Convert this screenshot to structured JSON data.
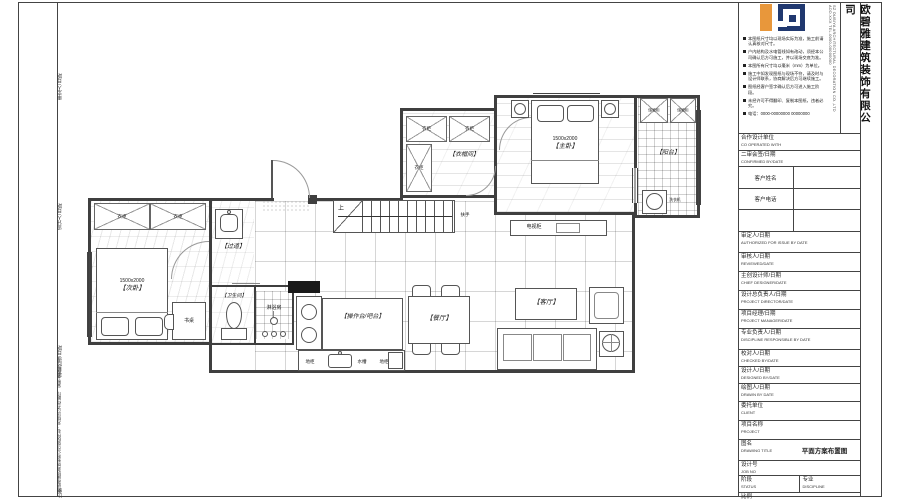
{
  "frame": {
    "edge_labels": {
      "l1": "审定人/日期",
      "l2": "设计人/日期",
      "l3": "项目经理/日期",
      "l4": "欧碧雅建筑装饰有限公司版权所有 · 未经许可不得翻印、复制本图纸",
      "l5": "比例"
    }
  },
  "header": {
    "company_vertical": "欧碧雅建筑装饰有限公司",
    "fine_print": "SZ OUBIYA ARCHITECTURAL DECORATION CO.,LTD ADD.XXX TEL.0000-00000000",
    "notes": [
      "本图纸尺寸均以现场实际为准，施工前请认真核对尺寸。",
      "户内结构及水电管线如有改动，须经本公司确认后方可施工，并以现场交底为准。",
      "本图所有尺寸均以毫米（mm）为单位。",
      "施工中如发现图纸与现场不符，请及时与设计师联系，协商解决后方可继续施工。",
      "图纸经客户签字确认后方可进入施工阶段。",
      "未经许可不得翻印、复制本图纸，违者必究。",
      "电话：0000-00000000 00000000"
    ],
    "colors": {
      "orange": "#E8973B",
      "blue": "#20386F"
    }
  },
  "titleblock": {
    "rows": [
      {
        "zh": "合作设计单位",
        "en": "CO OPERATED WITH"
      },
      {
        "zh": "二审会签/日期",
        "en": "CONFIRMED BY/DATE"
      },
      {
        "zh": "客户姓名",
        "en": ""
      },
      {
        "zh": "客户电话",
        "en": ""
      },
      {
        "zh": "",
        "en": ""
      },
      {
        "zh": "审定人/日期",
        "en": "AUTHORIZED FOR ISSUE BY DATE"
      },
      {
        "zh": "审核人/日期",
        "en": "REVIEWED/DATE"
      },
      {
        "zh": "主创设计师/日期",
        "en": "CHIEF DESIGNER/DATE"
      },
      {
        "zh": "设计总负责人/日期",
        "en": "PROJECT DIRECTOR/DATE"
      },
      {
        "zh": "项目经理/日期",
        "en": "PROJECT MANAGER/DATE"
      },
      {
        "zh": "专业负责人/日期",
        "en": "DISCIPLINE RESPONSIBLE BY DATE"
      },
      {
        "zh": "校对人/日期",
        "en": "CHECKED BY/DATE"
      },
      {
        "zh": "设计人/日期",
        "en": "DESIGNED BY/DATE"
      },
      {
        "zh": "绘图人/日期",
        "en": "DRAWN BY DATE"
      },
      {
        "zh": "委托单位",
        "en": "CLIENT"
      },
      {
        "zh": "项目名称",
        "en": "PROJECT"
      },
      {
        "zh": "图名",
        "en": "DRAWING TITLE",
        "value": "平面方案布置图"
      },
      {
        "zh": "设计号",
        "en": "JOB NO"
      },
      {
        "zh": "阶段",
        "en": "STATUS",
        "zh2": "专业",
        "en2": "DISCIPLINE"
      },
      {
        "zh": "比例",
        "en": "SCALE"
      }
    ]
  },
  "plan": {
    "bedroom2": {
      "label": "【次卧】",
      "bed_size": "1500x2000",
      "wardrobe1": "衣柜",
      "wardrobe2": "衣柜",
      "desk": "书桌"
    },
    "corridor": {
      "label": "【过道】"
    },
    "bathroom": {
      "label": "【卫生间】",
      "shower": "淋浴房"
    },
    "kitchen": {
      "island": "【操作台/吧台】",
      "cab1": "地柜",
      "sink": "水槽",
      "cab2": "地柜"
    },
    "dining": {
      "label": "【餐厅】"
    },
    "living": {
      "label": "【客厅】"
    },
    "stairs": {
      "up": "上",
      "rail": "扶手"
    },
    "closet": {
      "label": "【衣帽间】",
      "w1": "衣柜",
      "w2": "衣柜",
      "w3": "衣柜"
    },
    "master": {
      "label": "【主卧】",
      "bed_size": "1500x2000",
      "tv": "电视柜"
    },
    "balcony": {
      "label": "【阳台】",
      "cab1": "储物柜",
      "cab2": "储物柜",
      "washer": "洗衣机"
    }
  }
}
